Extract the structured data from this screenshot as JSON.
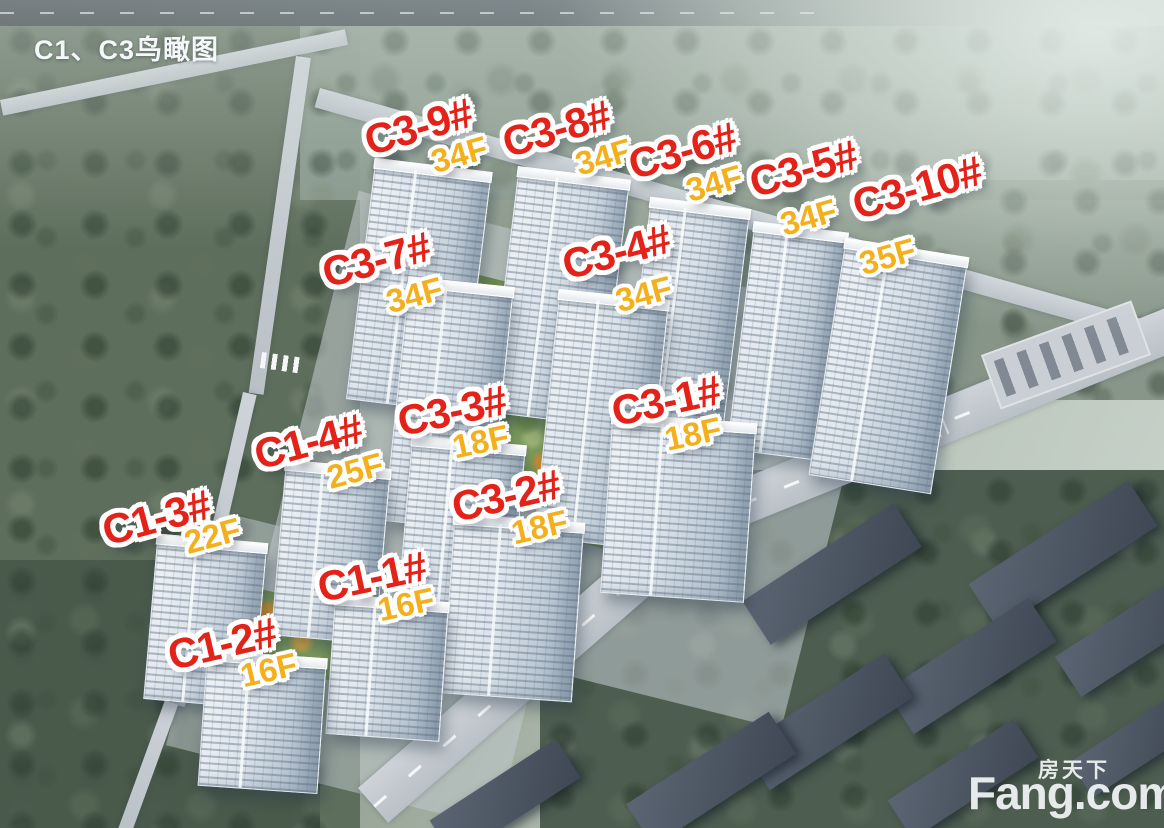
{
  "header": {
    "title": "C1、C3鸟瞰图"
  },
  "buildings": [
    {
      "name": "C3-9#",
      "floors": "34F"
    },
    {
      "name": "C3-8#",
      "floors": "34F"
    },
    {
      "name": "C3-6#",
      "floors": "34F"
    },
    {
      "name": "C3-5#",
      "floors": "34F"
    },
    {
      "name": "C3-10#",
      "floors": "35F"
    },
    {
      "name": "C3-7#",
      "floors": "34F"
    },
    {
      "name": "C3-4#",
      "floors": "34F"
    },
    {
      "name": "C3-3#",
      "floors": "18F"
    },
    {
      "name": "C1-4#",
      "floors": "25F"
    },
    {
      "name": "C3-1#",
      "floors": "18F"
    },
    {
      "name": "C3-2#",
      "floors": "18F"
    },
    {
      "name": "C1-3#",
      "floors": "22F"
    },
    {
      "name": "C1-1#",
      "floors": "16F"
    },
    {
      "name": "C1-2#",
      "floors": "16F"
    }
  ],
  "watermark": {
    "brand_cn": "房天下",
    "brand_en": "Fang.com"
  },
  "colors": {
    "label_red": "#e3221a",
    "floor_gold": "#f4b01c",
    "title_white": "#f5f8f9",
    "watermark_white": "#f2f4f5"
  }
}
